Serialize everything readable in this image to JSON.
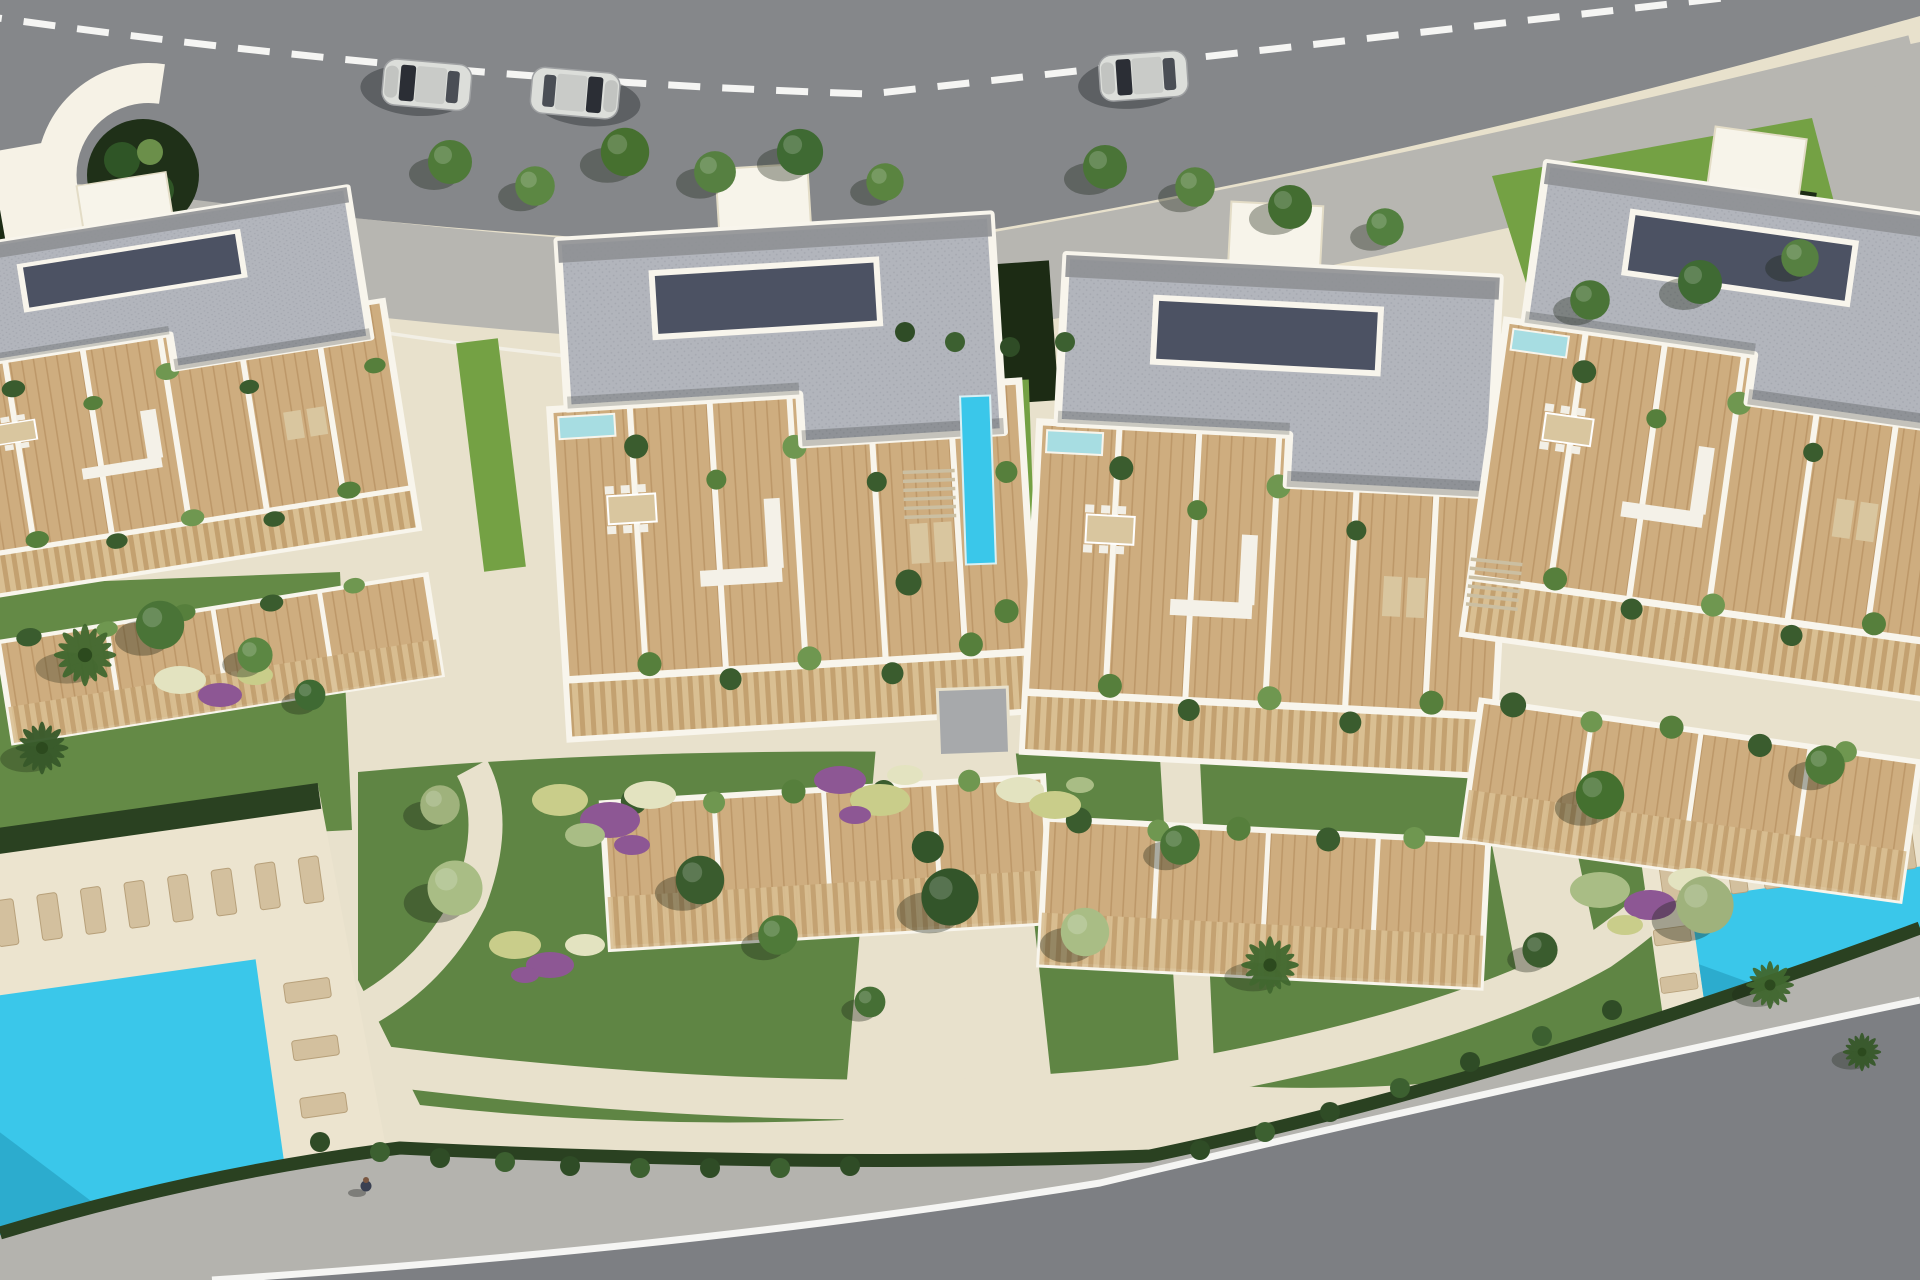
{
  "meta": {
    "kind": "architectural-aerial-render",
    "description": "Top-down 3D rendered site plan of a modern residential complex: four apartment blocks with grey flat roofs and timber roof terraces, communal gardens with winding paths, two turquoise swimming pools with sun loungers, bounded by a curved road with dashed centre line at the top and a curved road at the bottom."
  },
  "scene": {
    "roads": {
      "top": {
        "marking": "white dashed centre line",
        "cars_on_road": 3
      },
      "bottom": {
        "marking": "white edge line",
        "cars_on_road": 0
      }
    },
    "cars": [
      {
        "color": "silver",
        "heading": "west"
      },
      {
        "color": "silver-dark-front",
        "heading": "west"
      },
      {
        "color": "silver",
        "heading": "west"
      }
    ],
    "buildings": {
      "count": 4,
      "style": "flat grey roof, white parapet trim, recessed dark roof well, timber terrace decks with white partition walls, private plunge pools, terrace furniture and planters"
    },
    "pools": {
      "communal_count": 2,
      "shape": "rectangular",
      "loungers_visible": true
    },
    "gardens": {
      "features": [
        "lawns",
        "clipped dark hedges",
        "round trees",
        "palm trees",
        "purple and yellow flower beds",
        "cream winding paths",
        "paver square",
        "outdoor stairs"
      ]
    },
    "people": {
      "count": 1,
      "location": "bottom sidewalk"
    }
  },
  "colors": {
    "hardscape": "#e8e1cc",
    "sidewalk": "#b7b6b1",
    "sidewalk_bottom": "#b4b3ae",
    "road_top": "#85878a",
    "road_bottom": "#7d7f83",
    "lane_line": "#f5f5f3",
    "curb": "#f2efe5",
    "lawn": "#5f8544",
    "lawn_bright": "#74a144",
    "lawn_left": "#648a46",
    "hedge": "#2a4121",
    "hedge_dark": "#1c2b14",
    "palm": "#41682f",
    "flower_purple": "#8d5794",
    "flower_yellow": "#c9cd8a",
    "flower_light": "#e3e3c0",
    "flower_sage": "#a9bd85",
    "pool": "#3ac7ea",
    "pool_deep": "#2aa7c9",
    "plunge": "#a7dde2",
    "deck_cream": "#ece4cf",
    "terrace": "#cead7f",
    "terrace_line": "#bd9869",
    "slat_dark": "#c3a170",
    "slat_light": "#d9bf92",
    "trim": "#f8f5ec",
    "roof": "#b2b5bc",
    "roof_dot": "#a5a8b0",
    "roof_band": "#8e9094",
    "roof_inset": "#4c5263",
    "building_white": "#f7f4ea",
    "furniture": "#d9c69f",
    "lounger": "#d3c09e",
    "paver": "#a7a9ab",
    "stair": "#cbbfa2",
    "car_body": "#dcdeda",
    "car_glass": "#2b2e35",
    "car_roof": "#c9cbc8",
    "person": "#3a4052"
  }
}
